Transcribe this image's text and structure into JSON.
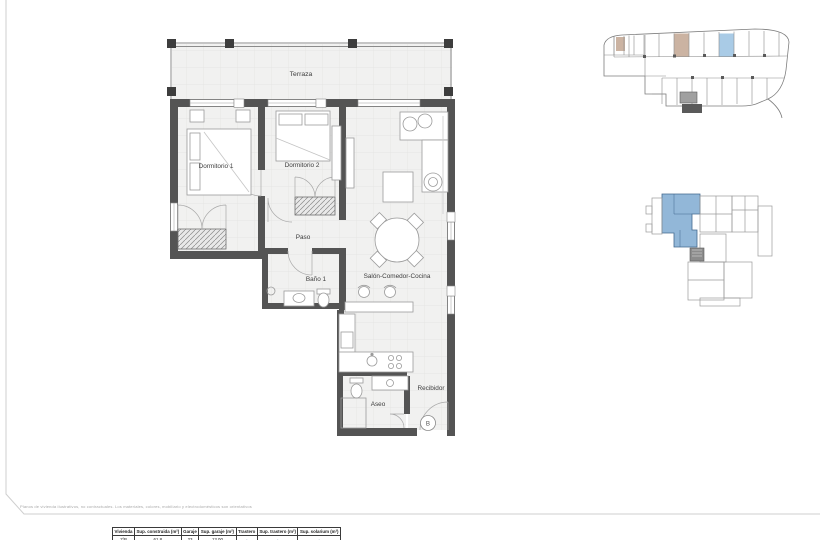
{
  "page": {
    "disclaimer": "Planos de vivienda ilustrativos, no contractuales. Los materiales, colores, mobiliario y electrodomésticos son orientativos"
  },
  "plan": {
    "rooms": {
      "terraza": "Terraza",
      "dormitorio1": "Dormitorio 1",
      "dormitorio2": "Dormitorio 2",
      "paso": "Paso",
      "bano1": "Baño 1",
      "salon": "Salón-Comedor-Cocina",
      "aseo": "Aseo",
      "recibidor": "Recibidor"
    },
    "door_letter": "B"
  },
  "summary_table": {
    "headers": [
      "Vivienda",
      "Sup. construida (m²)",
      "Garaje",
      "Sup. garaje (m²)",
      "Trastero",
      "Sup. trastero (m²)",
      "Sup. solarium (m²)"
    ],
    "rows": [
      [
        "1ºB",
        "61.8",
        "23",
        "13.00",
        "-",
        "-",
        "-"
      ]
    ]
  },
  "colors": {
    "highlight_blue": "#a9cbe6",
    "highlight_tan": "#cbb3a2",
    "keyplan_blue": "#86afd4",
    "wall": "#545454"
  }
}
